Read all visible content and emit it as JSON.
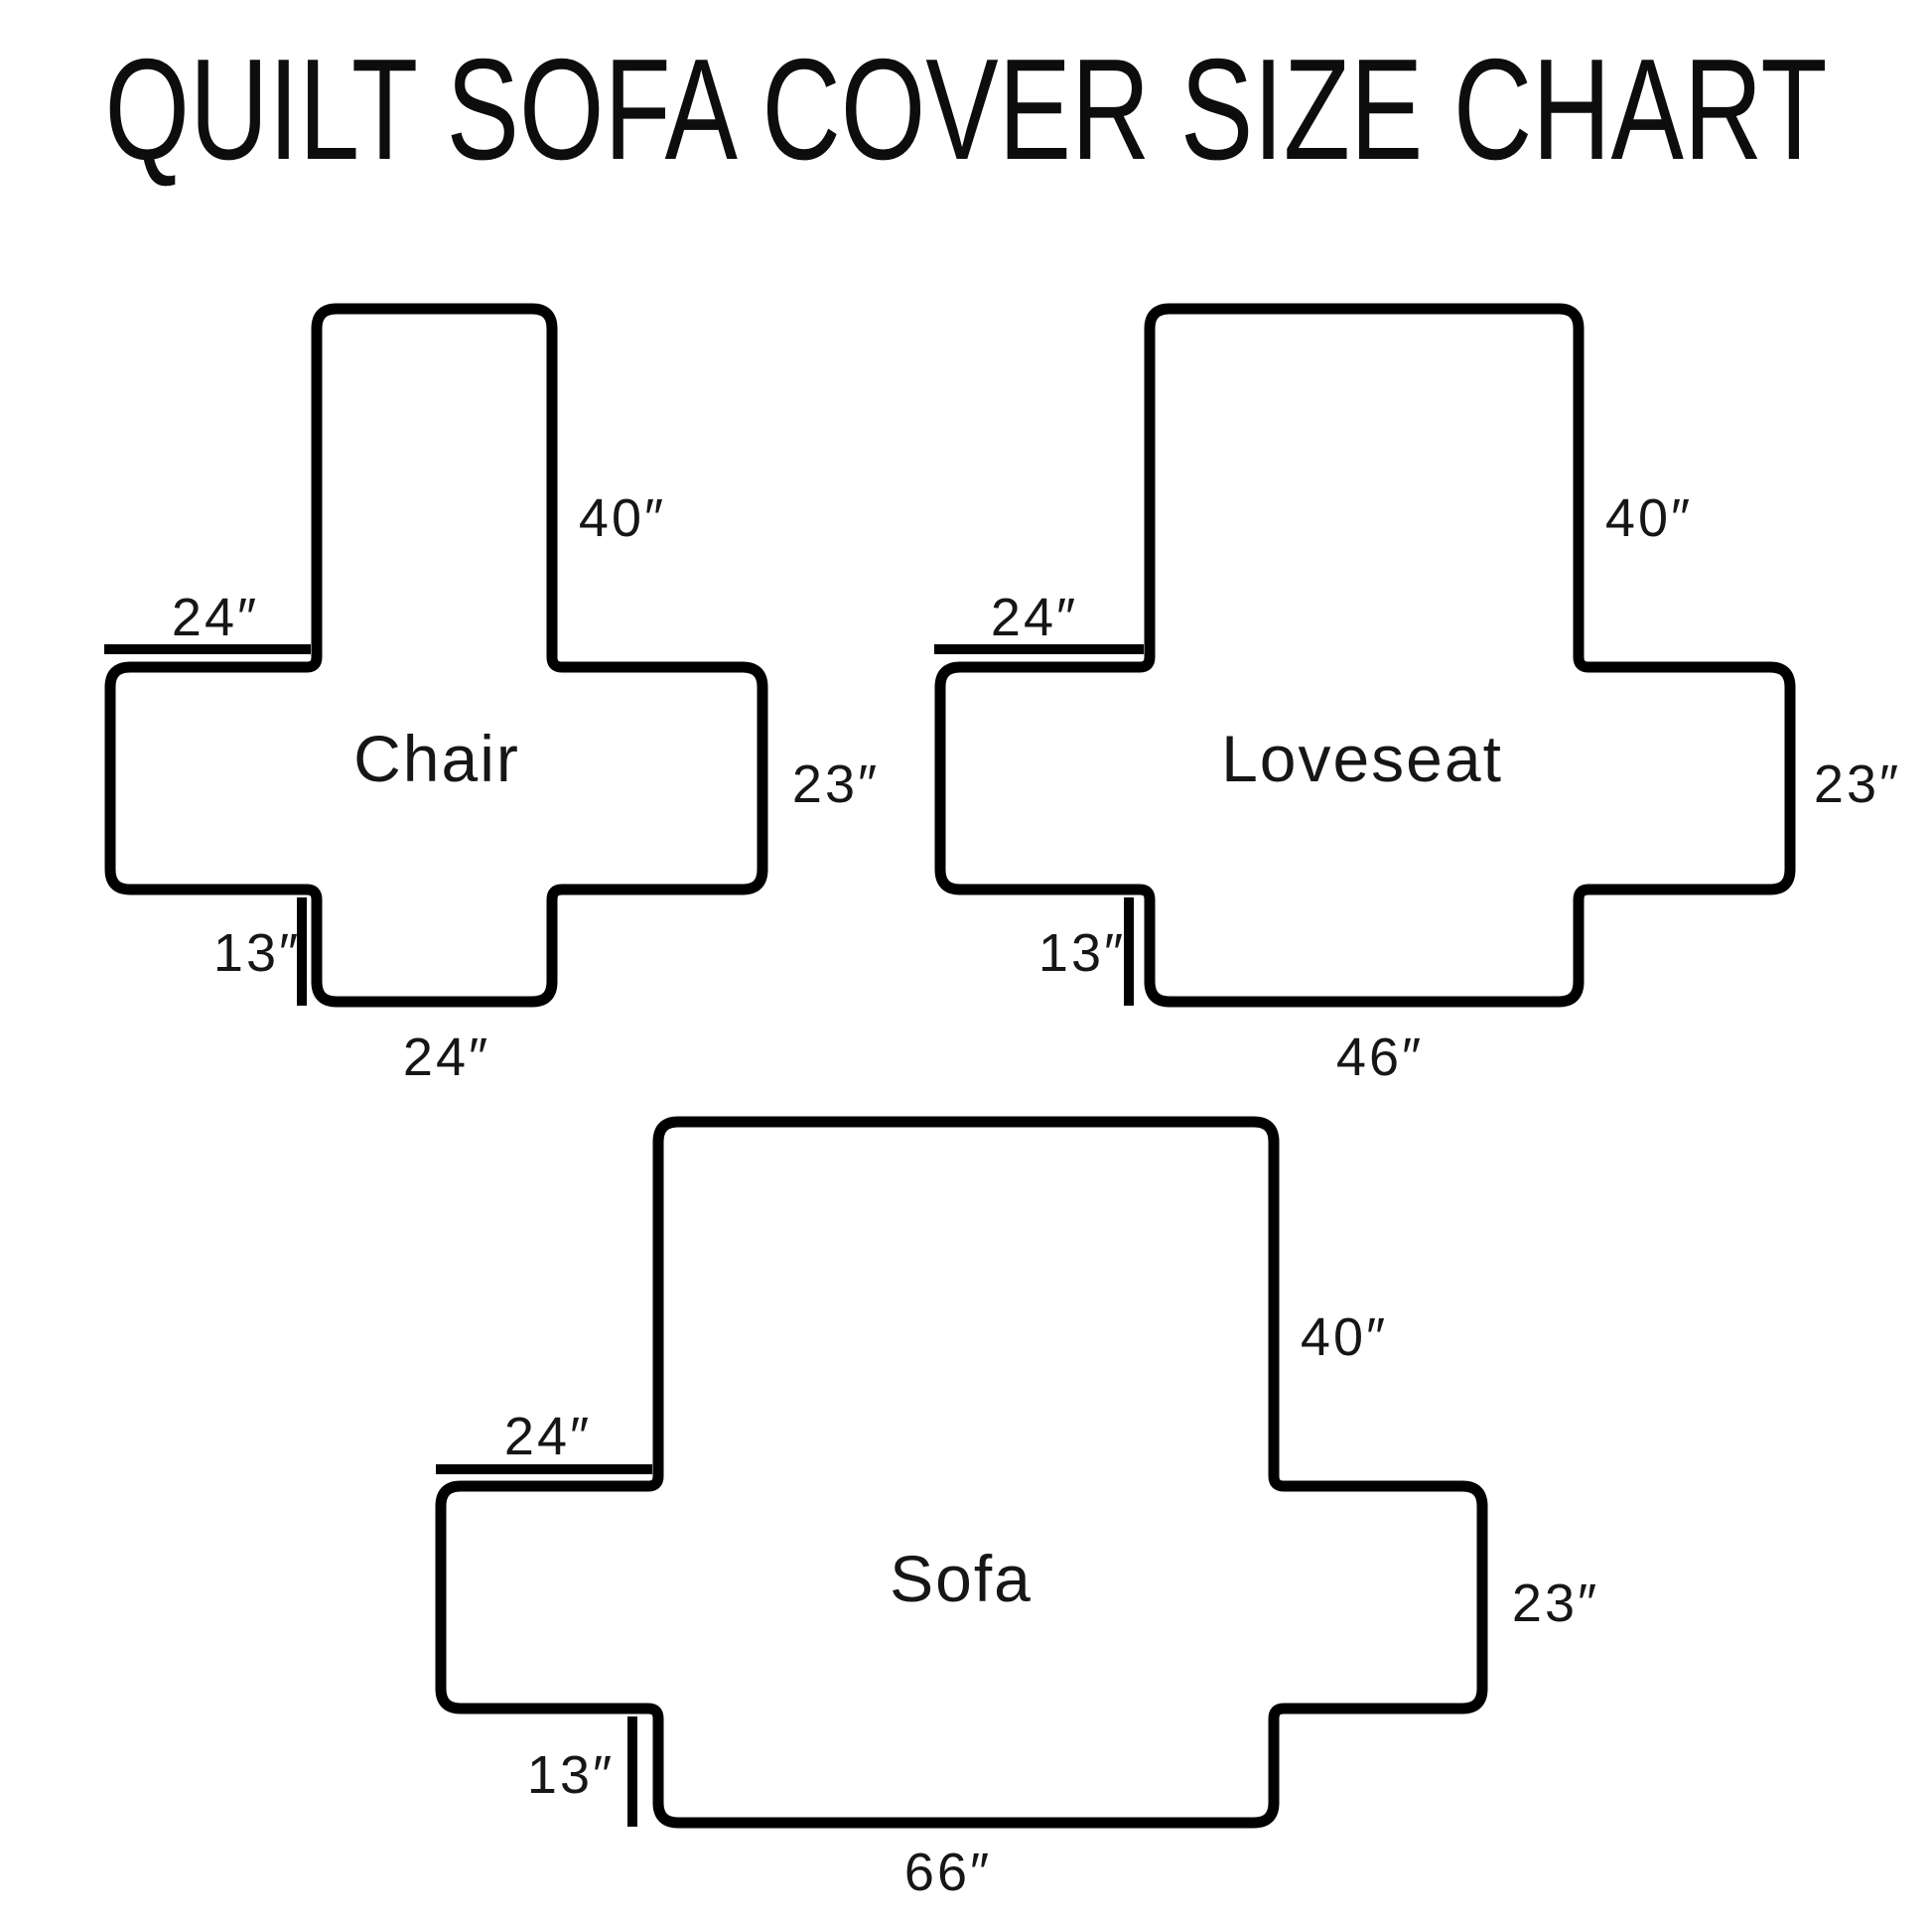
{
  "title": "QUILT SOFA COVER SIZE CHART",
  "colors": {
    "line": "#000000",
    "background": "#ffffff",
    "text": "#161616"
  },
  "diagrams": [
    {
      "name": "Chair",
      "labels": {
        "back_height": "40″",
        "arm_depth": "24″",
        "arm_height": "23″",
        "flap_height": "13″",
        "bottom_width": "24″"
      },
      "dimensions_in": {
        "back_height": 40,
        "arm_depth": 24,
        "arm_height": 23,
        "flap_height": 13,
        "bottom_width": 24
      }
    },
    {
      "name": "Loveseat",
      "labels": {
        "back_height": "40″",
        "arm_depth": "24″",
        "arm_height": "23″",
        "flap_height": "13″",
        "bottom_width": "46″"
      },
      "dimensions_in": {
        "back_height": 40,
        "arm_depth": 24,
        "arm_height": 23,
        "flap_height": 13,
        "bottom_width": 46
      }
    },
    {
      "name": "Sofa",
      "labels": {
        "back_height": "40″",
        "arm_depth": "24″",
        "arm_height": "23″",
        "flap_height": "13″",
        "bottom_width": "66″"
      },
      "dimensions_in": {
        "back_height": 40,
        "arm_depth": 24,
        "arm_height": 23,
        "flap_height": 13,
        "bottom_width": 66
      }
    }
  ]
}
